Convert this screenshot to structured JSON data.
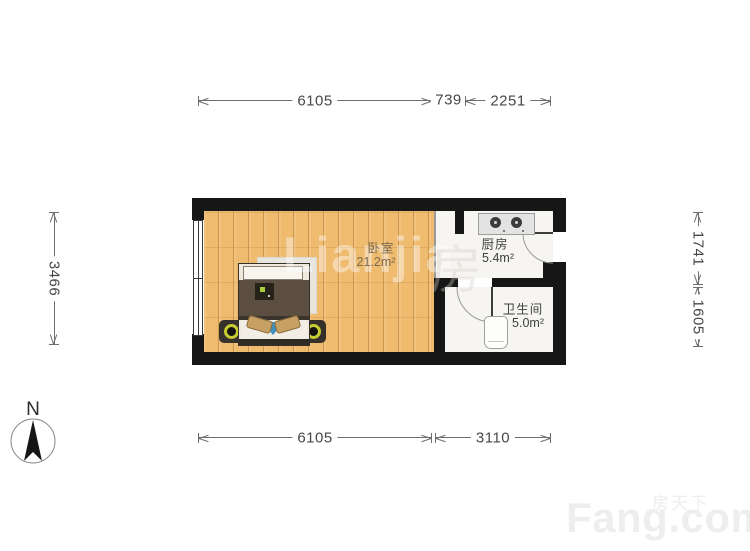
{
  "plan": {
    "watermark": "Lianjia",
    "watermark_glyph": "房",
    "rooms": [
      {
        "id": "bedroom",
        "name": "卧室",
        "area": "21.2m²"
      },
      {
        "id": "kitchen",
        "name": "厨房",
        "area": "5.4m²"
      },
      {
        "id": "bathroom",
        "name": "卫生间",
        "area": "5.0m²"
      }
    ]
  },
  "dimensions": {
    "top": [
      "6105",
      "739",
      "2251"
    ],
    "bottom": [
      "6105",
      "3110"
    ],
    "left": [
      "3466"
    ],
    "right": [
      "1741",
      "1605"
    ]
  },
  "compass": {
    "label": "N"
  },
  "branding": {
    "site_cn": "房天下",
    "site_en": "Fang.com"
  },
  "colors": {
    "wall": "#161616",
    "wood_floor": "#eebb6f",
    "tile_floor": "#f6f5f1",
    "accent_blue": "#3f8fbf",
    "lamp_yellow": "#c6cc31",
    "dimension_line": "#6e6e6e"
  }
}
